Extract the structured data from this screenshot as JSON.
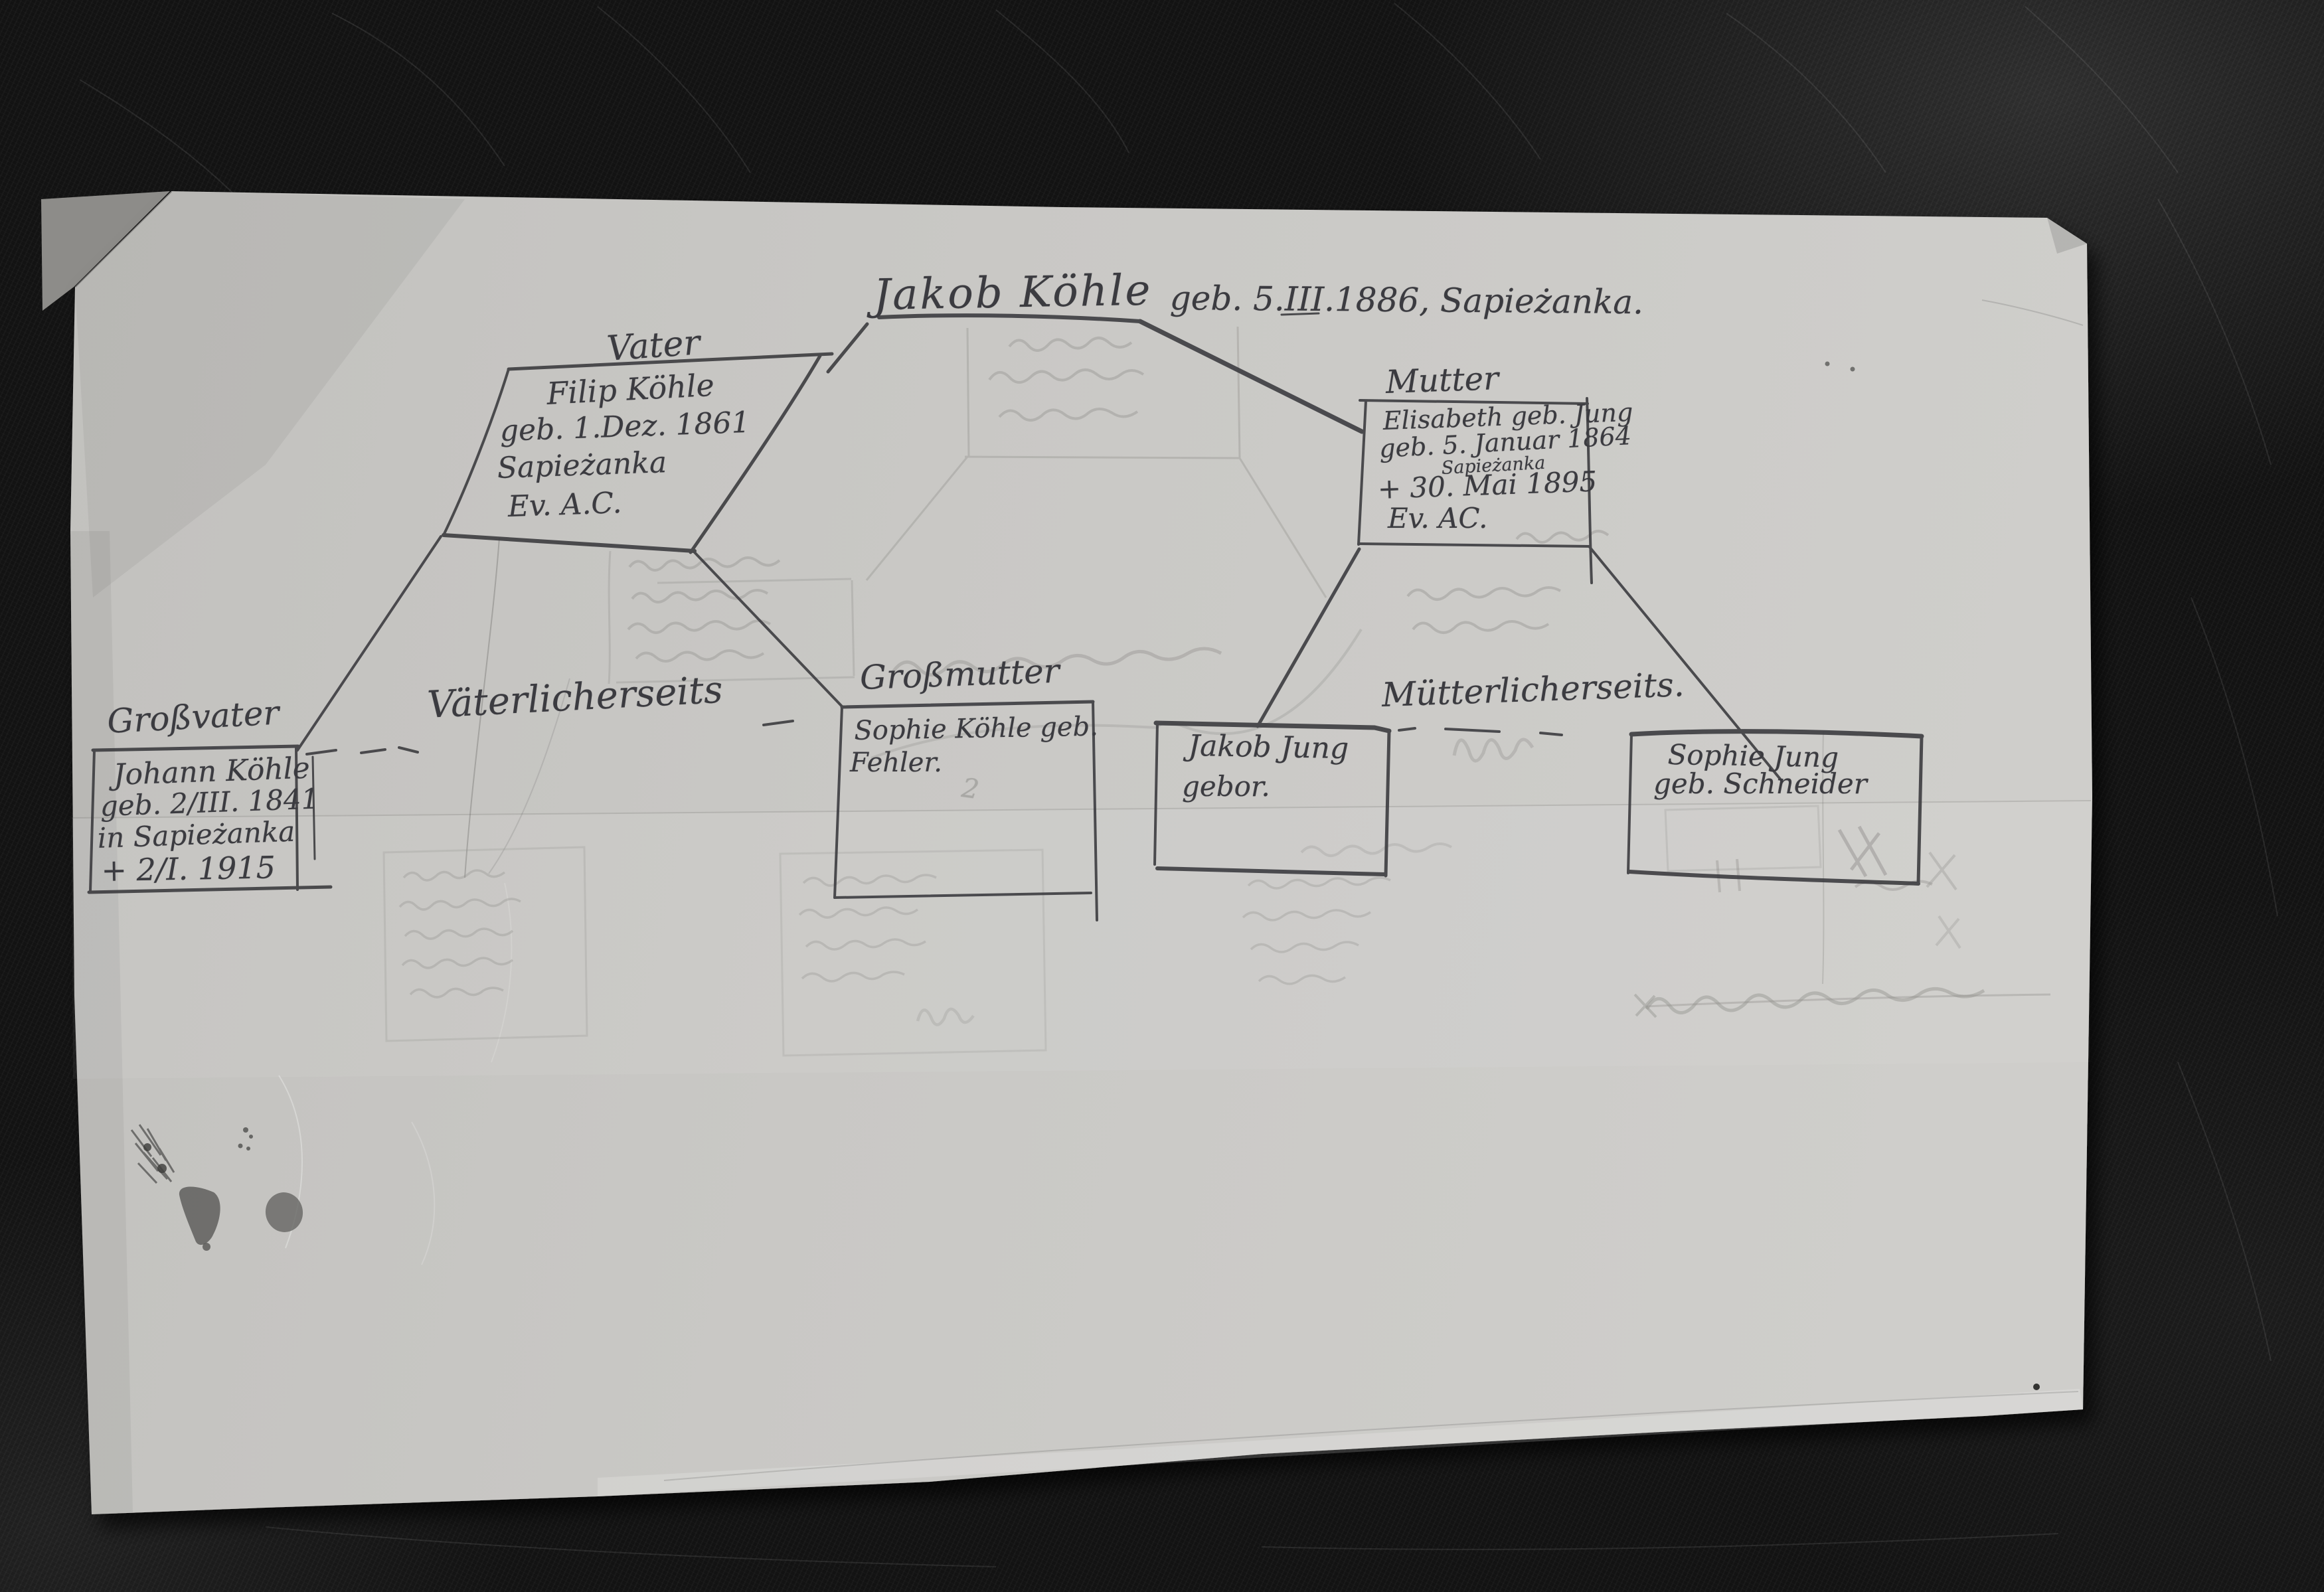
{
  "title": {
    "name": "Jakob Köhle",
    "birth": "geb. 5.III.1886, Sapieżanka."
  },
  "boxes": {
    "vater": {
      "label": "Vater",
      "line1": "Filip Köhle",
      "line2": "geb. 1.Dez. 1861",
      "line3": "Sapieżanka",
      "line4": "Ev. A.C."
    },
    "mutter": {
      "label": "Mutter",
      "line1": "Elisabeth geb. Jung",
      "line2": "geb. 5. Januar 1864",
      "line2b": "Sapieżanka",
      "line3": "+ 30. Mai 1895",
      "line4": "Ev. AC."
    },
    "grossvater": {
      "label": "Großvater",
      "line1": "Johann Köhle",
      "line2": "geb. 2/III. 1841",
      "line3": "in Sapieżanka",
      "line4": "+ 2/I. 1915"
    },
    "grossmutter": {
      "label": "Großmutter",
      "line1": "Sophie Köhle geb.",
      "line2": "Fehler.",
      "note": "2"
    },
    "jakob_jung": {
      "line1": "Jakob Jung",
      "line2": "gebor."
    },
    "sophie_jung": {
      "line1": "Sophie Jung",
      "line2": "geb. Schneider"
    }
  },
  "branch_labels": {
    "paternal": "Väterlicherseits",
    "maternal": "Mütterlicherseits."
  },
  "colors": {
    "leather": "#131313",
    "paper": "#c9c8c5",
    "ink": "#3c3c40",
    "pencil_ghost": "#93928f"
  }
}
